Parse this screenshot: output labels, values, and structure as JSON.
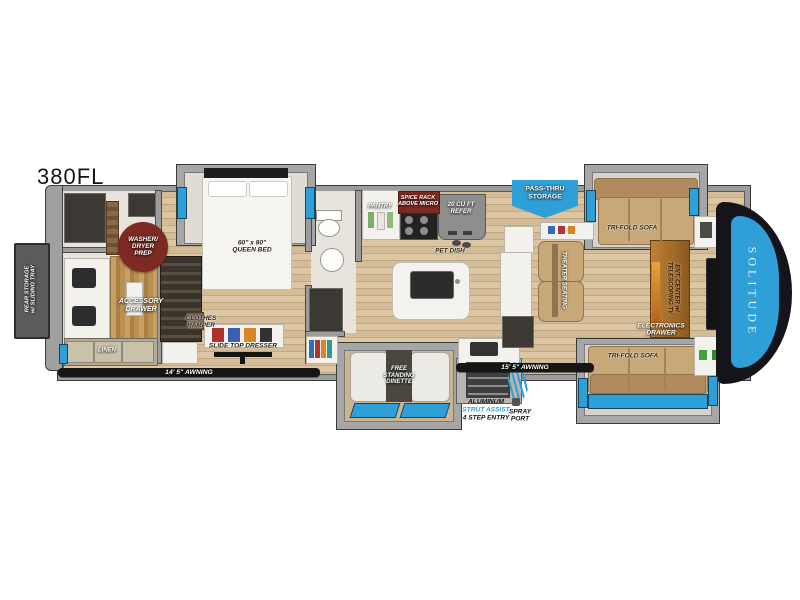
{
  "model": "380FL",
  "brand": "SOLITUDE",
  "colors": {
    "accent_blue": "#2f9fd8",
    "awning_black": "#161616",
    "maroon": "#7d2a22",
    "wood_floor": "#cbb28c",
    "wall_gray": "#9c9c9c",
    "sofa_tan": "#c8a876"
  },
  "labels": {
    "rear_storage": "REAR STORAGE\nw/ SLIDING TRAY",
    "washer_dryer": "WASHER/\nDRYER\nPREP",
    "accessory_drawer": "ACCESSORY\nDRAWER",
    "linen": "LINEN",
    "queen_bed": "60\" x 80\"\nQUEEN BED",
    "clothes_hamper": "CLOTHES\nHAMPER",
    "slide_top_dresser": "SLIDE TOP DRESSER",
    "awning_left": "14' 5\" AWNING",
    "pantry": "PANTRY",
    "spice_rack": "SPICE RACK\nABOVE MICRO",
    "refer": "20 CU FT\nREFER",
    "pet_dish": "PET DISH",
    "pass_thru": "PASS-THRU\nSTORAGE",
    "tri_fold_sofa_top": "TRI-FOLD SOFA",
    "tri_fold_sofa_bottom": "TRI-FOLD SOFA",
    "theater_seating": "THEATER SEATING",
    "ent_center": "ENT. CENTER w/\nTELESCOPING TV",
    "electronics_drawer": "ELECTRONICS\nDRAWER",
    "awning_right": "15' 5\" AWNING",
    "free_standing_dinette": "FREE\nSTANDING\nDINETTE",
    "entry_line1": "ALUMINUM",
    "entry_line2": "STRUT ASSIST",
    "entry_line3": "4 STEP ENTRY",
    "spray_port": "SPRAY\nPORT"
  }
}
